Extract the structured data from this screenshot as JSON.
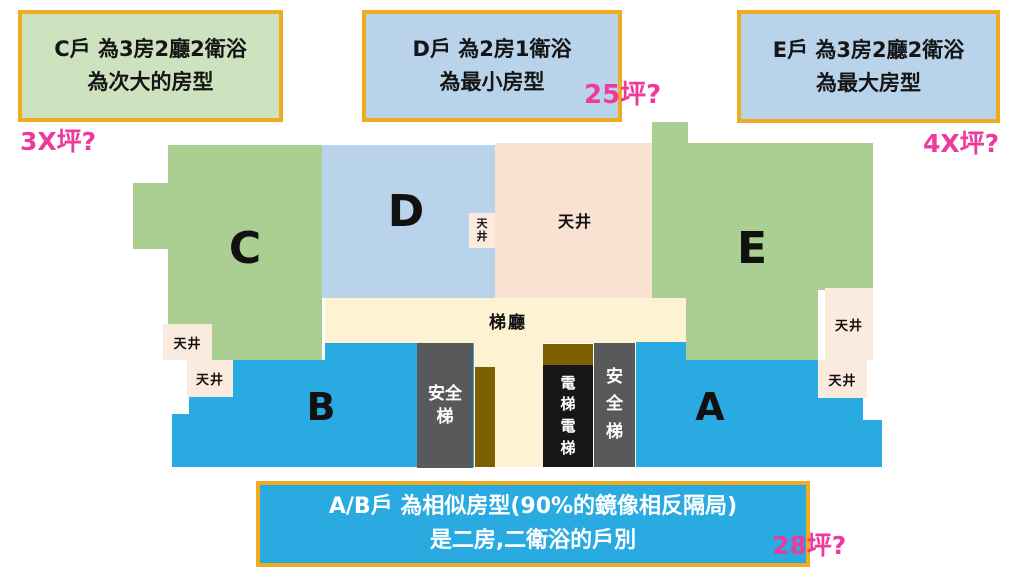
{
  "callouts": {
    "c": {
      "line1": "C戶 為3房2廳2衛浴",
      "line2": "為次大的房型",
      "note": "3X坪?"
    },
    "d": {
      "line1": "D戶 為2房1衛浴",
      "line2": "為最小房型",
      "note": "25坪?"
    },
    "e": {
      "line1": "E戶 為3房2廳2衛浴",
      "line2": "為最大房型",
      "note": "4X坪?"
    },
    "ab": {
      "line1": "A/B戶 為相似房型(90%的鏡像相反隔局)",
      "line2": "是二房,二衛浴的戶別",
      "note": "28坪?"
    }
  },
  "units": {
    "a": "A",
    "b": "B",
    "c": "C",
    "d": "D",
    "e": "E"
  },
  "labels": {
    "lightwell": "天井",
    "lightwell_stacked": "天\n井",
    "hall": "梯廳",
    "stair_left": "安全\n梯",
    "stair_right": "安\n全\n梯",
    "elevator": "電\n梯\n電\n梯"
  },
  "colors": {
    "unit_green": "#abce92",
    "unit_blue": "#b9d3ea",
    "unit_cyan": "#29abe2",
    "lightwell_peach": "#f9e2d2",
    "hall_yellow": "#fdf3d2",
    "stair_gray": "#58595b",
    "shaft_brown": "#7e6000",
    "elevator_black": "#161616",
    "callout_border": "#efac20",
    "note_magenta": "#ee3a9d"
  }
}
